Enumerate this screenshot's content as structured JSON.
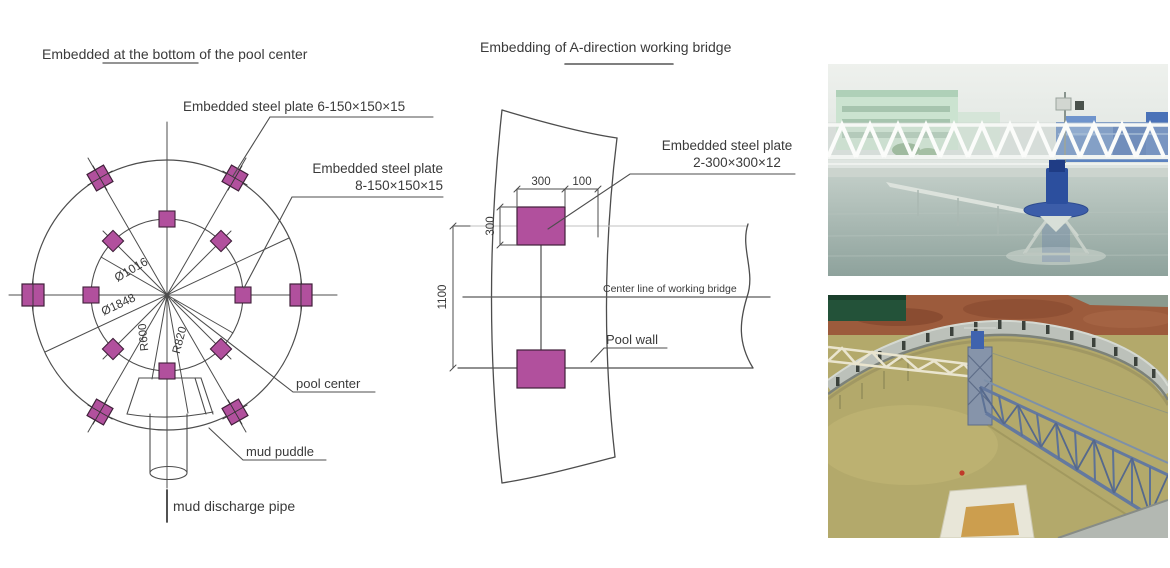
{
  "palette": {
    "plate_fill": "#b1509d",
    "plate_stroke": "#40203a",
    "line_color": "#4d4d4d",
    "text_color": "#3a3a3a"
  },
  "left_diagram": {
    "title": {
      "part1": "Embedded ",
      "part2_underlined": "at the bottom of ",
      "part3": "the pool center"
    },
    "labels": {
      "plate6": "Embedded steel plate 6-150×150×15",
      "plate8_line1": "Embedded steel plate",
      "plate8_line2": "8-150×150×15",
      "pool_center": "pool center",
      "mud_puddle": "mud puddle",
      "mud_discharge_pipe": "mud discharge pipe"
    },
    "dimensions": {
      "inner_circle_diameter": "Ø1016",
      "outer_circle_diameter": "Ø1848",
      "mud_puddle_inner_radius": "R600",
      "mud_puddle_outer_radius": "R820"
    }
  },
  "middle_diagram": {
    "title": "Embedding of A-direction working bridge",
    "labels": {
      "plate_line1": "Embedded steel plate",
      "plate_line2": "2-300×300×12",
      "center_line": "Center line of working bridge",
      "pool_wall": "Pool wall"
    },
    "dimensions": {
      "plate_width": "300",
      "edge_offset": "100",
      "plate_height": "300",
      "plate_spacing": "1100"
    }
  }
}
